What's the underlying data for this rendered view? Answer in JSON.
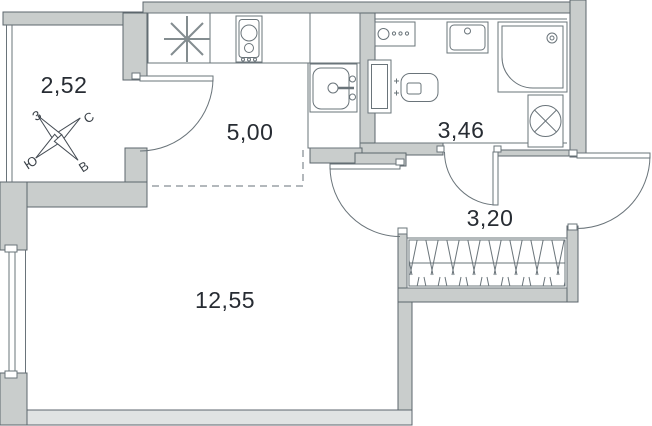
{
  "rooms": {
    "balcony": {
      "area": "2,52"
    },
    "kitchen": {
      "area": "5,00"
    },
    "bathroom": {
      "area": "3,46"
    },
    "hallway": {
      "area": "3,20"
    },
    "living_room": {
      "area": "12,55"
    }
  },
  "compass": {
    "north": "С",
    "south": "Ю",
    "west": "З",
    "east": "В"
  },
  "colors": {
    "wall_fill": "#c9cdcc",
    "wall_outline": "#5c666c",
    "light_wall_fill": "#e0e3e3",
    "fixture_line": "#6a747a",
    "dash_line": "#9aa1a5",
    "text": "#272c33",
    "background": "#ffffff"
  },
  "icons": [
    "compass-rose-icon",
    "vent-asterisk-icon",
    "hob-icon",
    "kitchen-sink-icon",
    "appliance-panel-icon",
    "bath-sink-icon",
    "shower-cabin-icon",
    "washing-machine-icon",
    "toilet-icon",
    "wardrobe-hatch-icon"
  ]
}
